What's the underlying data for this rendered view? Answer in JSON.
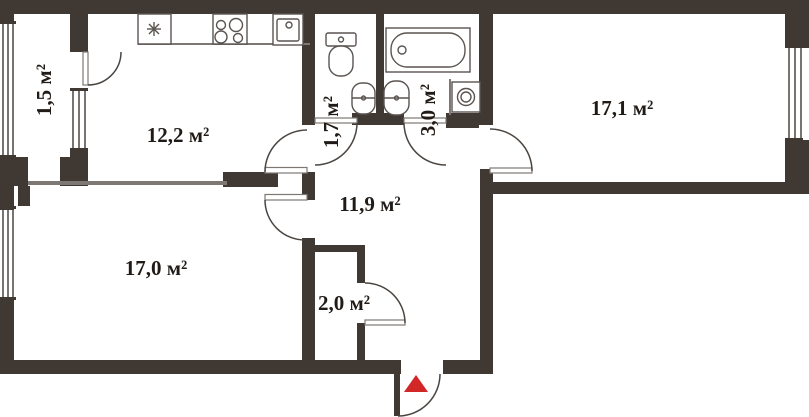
{
  "plan": {
    "title": "apartment-floor-plan",
    "rooms": [
      {
        "id": "balcony",
        "label": "1,5 м²"
      },
      {
        "id": "kitchen",
        "label": "12,2 м²"
      },
      {
        "id": "wc",
        "label": "1,7 м²"
      },
      {
        "id": "bathroom",
        "label": "3,0 м²"
      },
      {
        "id": "living-room",
        "label": "17,1 м²"
      },
      {
        "id": "hallway",
        "label": "11,9 м²"
      },
      {
        "id": "bedroom",
        "label": "17,0 м²"
      },
      {
        "id": "storage",
        "label": "2,0 м²"
      }
    ],
    "fixtures": [
      "freezer",
      "stove",
      "kitchen-sink",
      "toilet",
      "washbasin-wc",
      "bathtub",
      "washbasin-bath",
      "washing-machine"
    ],
    "entrance_marker": "entrance-arrow",
    "colors": {
      "wall": "#3f3833",
      "partition": "#7d7873",
      "door_arc": "#4b4541",
      "fixture": "#5a5450",
      "label": "#211b17",
      "entrance_arrow": "#d22727",
      "background": "#ffffff"
    }
  }
}
